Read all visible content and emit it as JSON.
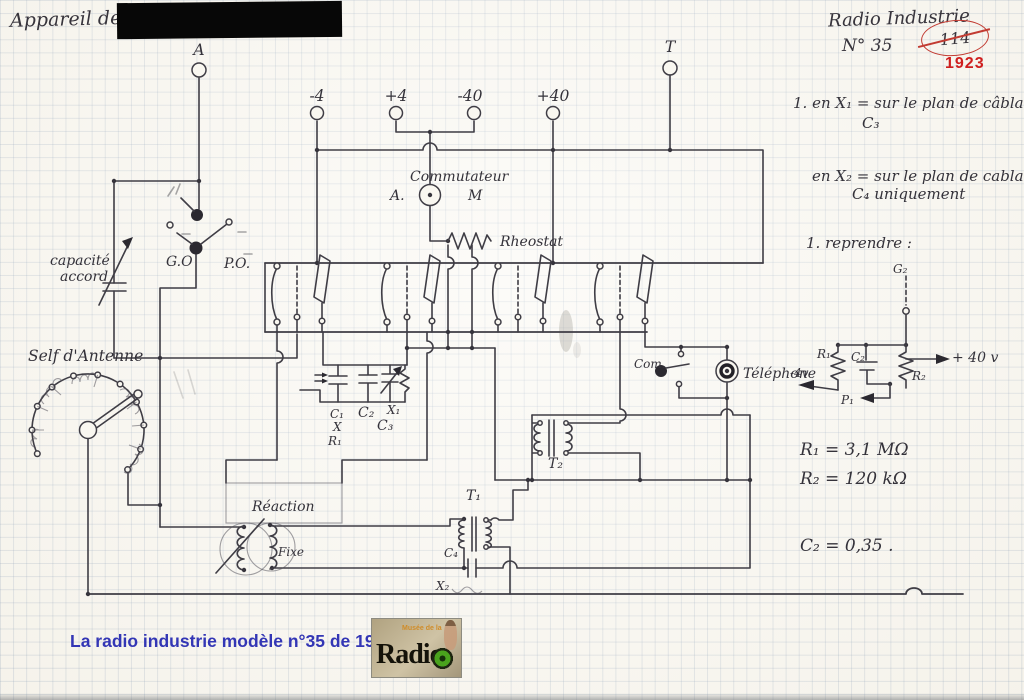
{
  "header": {
    "device_label": "Appareil de Mr",
    "brand": "Radio Industrie",
    "model": "N° 35",
    "crossed_number": "114",
    "year": "1923"
  },
  "terminals": {
    "antenna": "A",
    "earth": "T",
    "minus4": "-4",
    "plus4": "+4",
    "minus40": "-40",
    "plus40": "+40"
  },
  "schematic_labels": {
    "commutateur": "Commutateur",
    "pos_a": "A.",
    "pos_m": "M",
    "rheostat": "Rheostat",
    "capacite_1": "capacité",
    "capacite_2": "accord",
    "go": "G.O",
    "po": "P.O.",
    "self_antenne": "Self d'Antenne",
    "reaction": "Réaction",
    "fixe": "Fixe",
    "c1": "C₁",
    "c2": "C₂",
    "x1": "X₁",
    "c3": "C₃",
    "x": "X",
    "r1": "R₁",
    "t1": "T₁",
    "t2": "T₂",
    "c4": "C₄",
    "x2": "X₂",
    "com": "Com.",
    "telephone": "Téléphone"
  },
  "bias_circuit": {
    "g2": "G₂",
    "r1": "R₁",
    "c2": "C₂",
    "r2": "R₂",
    "p1": "P₁",
    "minus4v": "-4v",
    "plus40v": "+ 40 v"
  },
  "notes": {
    "n1a": "1. en X₁ =  sur le plan de câblage",
    "n1b": "C₃",
    "n2a": "en X₂ =  sur le plan de cablage",
    "n2b": "C₄ uniquement",
    "n3": "1.    reprendre  :"
  },
  "values": {
    "r1": "R₁  = 3,1 MΩ",
    "r2": "R₂  = 120 kΩ",
    "c2": "C₂  = 0,35 ."
  },
  "footer": {
    "caption": "La radio industrie modèle n°35 de 1923"
  },
  "logo": {
    "word": "Radio",
    "small": "Musée de la"
  }
}
